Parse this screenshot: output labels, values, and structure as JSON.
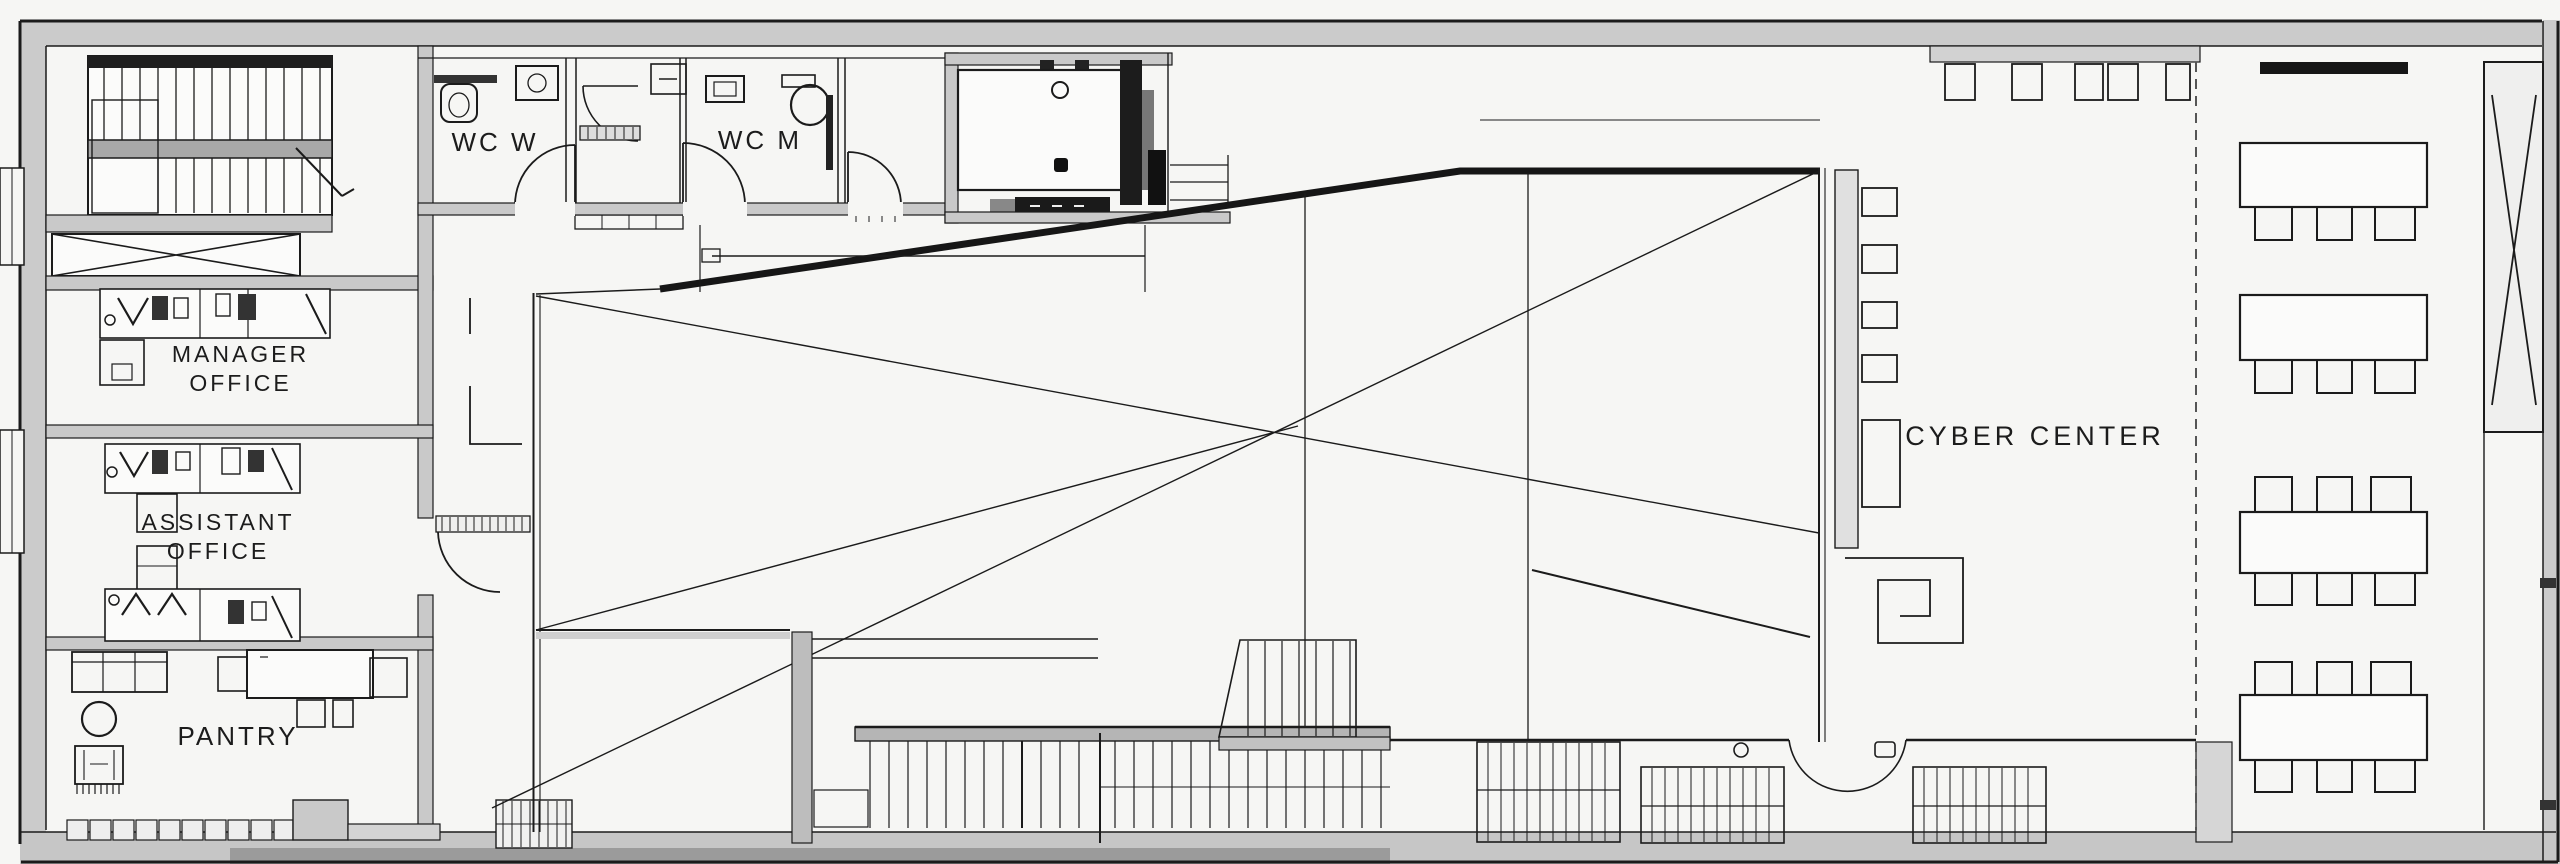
{
  "drawing": {
    "kind": "architectural floor plan",
    "palette": {
      "paper": "#f6f6f4",
      "ink": "#1b1b1b",
      "wall_fill": "#c9c9c9",
      "wall_fill_dark": "#9b9b9b",
      "dark_fill": "#161616"
    }
  },
  "rooms": {
    "wc_w": {
      "label": "WC W"
    },
    "wc_m": {
      "label": "WC M"
    },
    "manager_office": {
      "label_line1": "MANAGER",
      "label_line2": "OFFICE"
    },
    "assistant_office": {
      "label_line1": "ASSISTANT",
      "label_line2": "OFFICE"
    },
    "pantry": {
      "label": "PANTRY"
    },
    "cyber_center": {
      "label": "CYBER CENTER"
    }
  }
}
